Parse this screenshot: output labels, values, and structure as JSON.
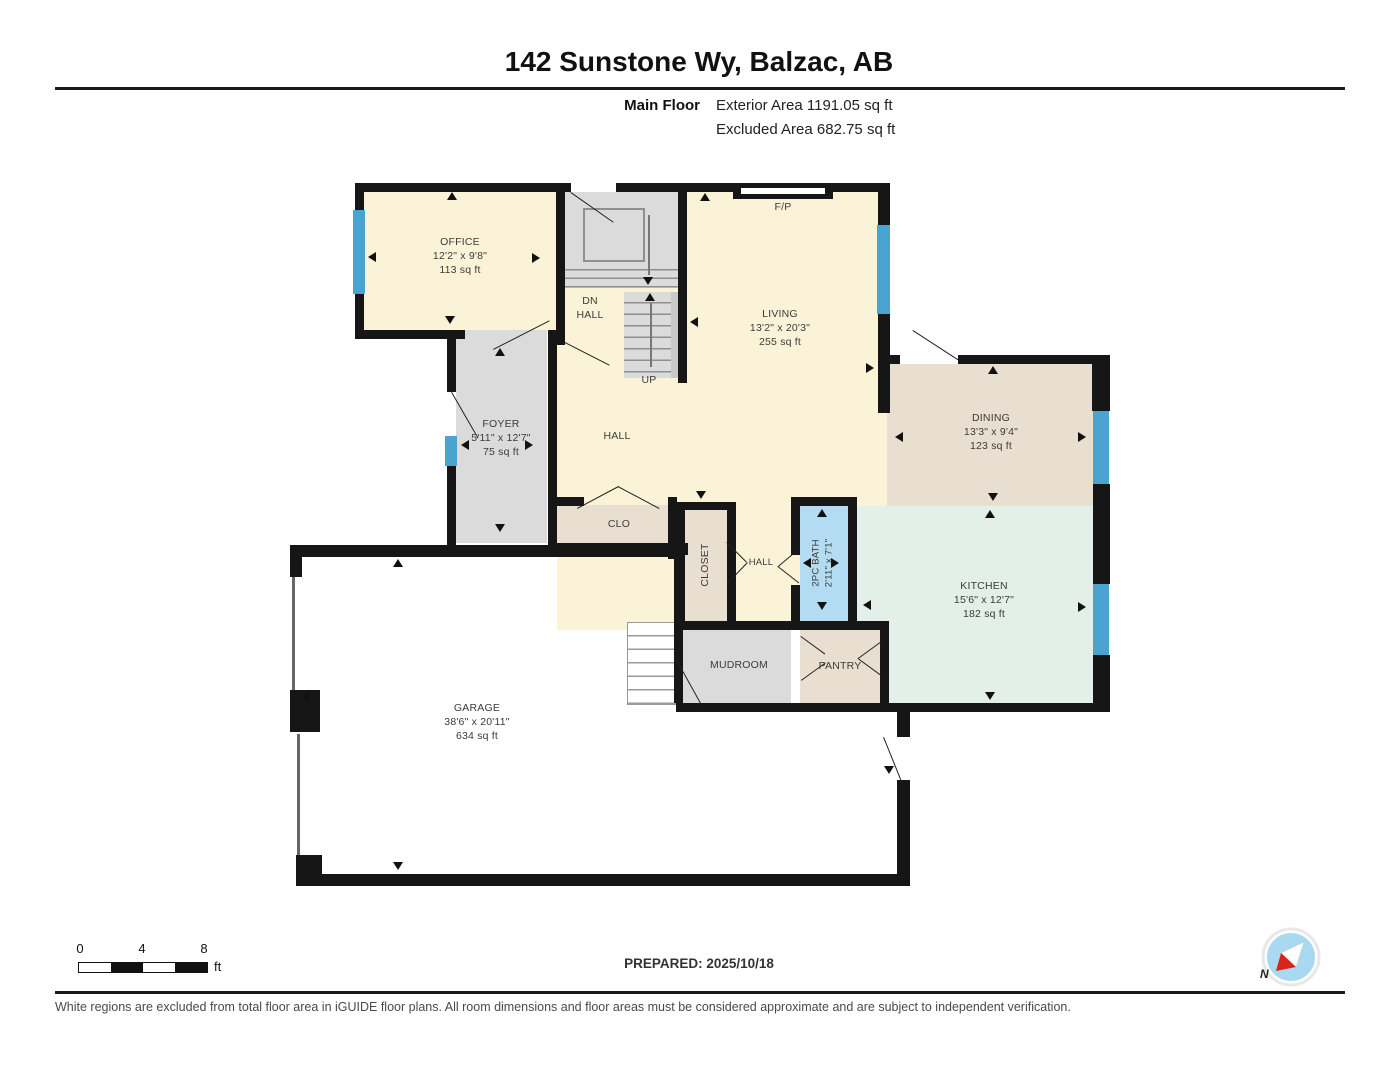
{
  "header": {
    "title": "142 Sunstone Wy, Balzac, AB",
    "floor_label": "Main Floor",
    "exterior_area_label": "Exterior Area 1191.05 sq ft",
    "excluded_area_label": "Excluded Area 682.75 sq ft"
  },
  "rooms": {
    "office": {
      "name": "OFFICE",
      "dims": "12'2\" x 9'8\"",
      "area": "113 sq ft"
    },
    "living": {
      "name": "LIVING",
      "dims": "13'2\" x 20'3\"",
      "area": "255 sq ft"
    },
    "dining": {
      "name": "DINING",
      "dims": "13'3\" x 9'4\"",
      "area": "123 sq ft"
    },
    "kitchen": {
      "name": "KITCHEN",
      "dims": "15'6\" x 12'7\"",
      "area": "182 sq ft"
    },
    "foyer": {
      "name": "FOYER",
      "dims": "5'11\" x 12'7\"",
      "area": "75 sq ft"
    },
    "garage": {
      "name": "GARAGE",
      "dims": "38'6\" x 20'11\"",
      "area": "634 sq ft"
    },
    "bath": {
      "name": "2PC BATH",
      "dims": "2'11\" x 7'1\""
    },
    "hall_main": "HALL",
    "hall_small": "HALL",
    "clo": "CLO",
    "closet": "CLOSET",
    "mudroom": "MUDROOM",
    "pantry": "PANTRY",
    "dn": "DN",
    "dn_hall": "HALL",
    "up": "UP",
    "fireplace": "F/P"
  },
  "scale_bar": {
    "t0": "0",
    "t4": "4",
    "t8": "8",
    "unit": "ft"
  },
  "footer": {
    "prepared": "PREPARED: 2025/10/18",
    "compass_north": "N",
    "disclaimer": "White regions are excluded from total floor area in iGUIDE floor plans. All room dimensions and floor areas must be considered approximate and are subject to independent verification."
  },
  "colors": {
    "wall": "#161616",
    "room_cream": "#FBF3D8",
    "room_gray": "#DBDBDB",
    "room_beige": "#E9DFD0",
    "room_mint": "#E3EFE9",
    "room_bath_blue": "#B3DCF2",
    "window_blue": "#4BA3CF",
    "compass_blue": "#A8D9F0",
    "compass_red": "#D8251C"
  }
}
